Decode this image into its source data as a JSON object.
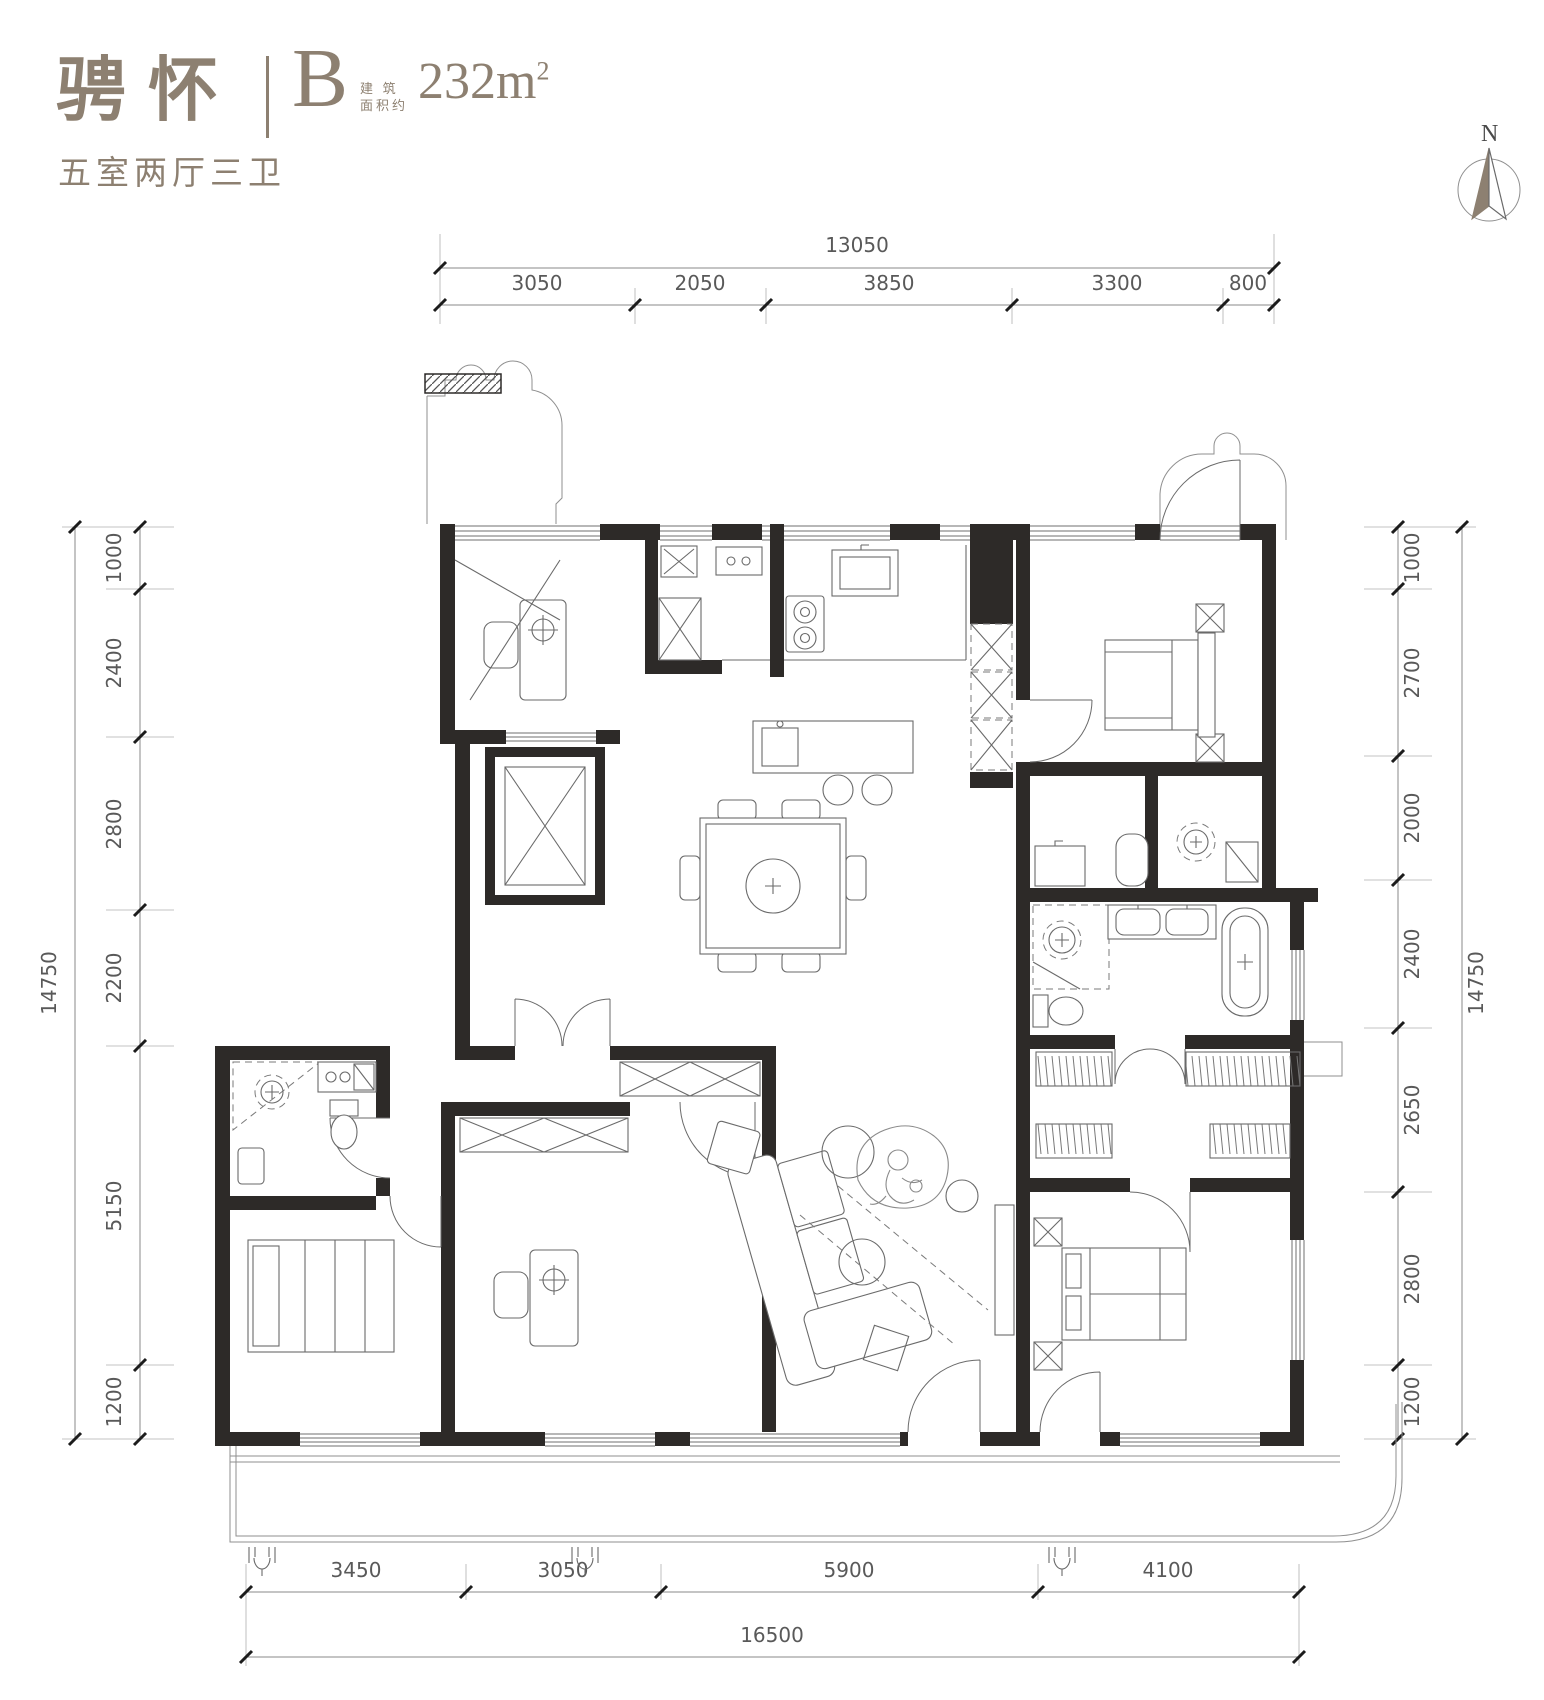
{
  "header": {
    "title": "骋怀",
    "unit": "B",
    "area_label_line1": "建 筑",
    "area_label_line2": "面积约",
    "area_value": "232m",
    "area_exponent": "2",
    "layout_summary": "五室两厅三卫"
  },
  "compass": {
    "north_label": "N"
  },
  "dimensions": {
    "top": {
      "total": "13050",
      "segments": [
        "3050",
        "2050",
        "3850",
        "3300",
        "800"
      ]
    },
    "bottom": {
      "total": "16500",
      "segments": [
        "3450",
        "3050",
        "5900",
        "4100"
      ]
    },
    "left": {
      "total": "14750",
      "segments": [
        "1000",
        "2400",
        "2800",
        "2200",
        "5150",
        "1200"
      ]
    },
    "right": {
      "total": "14750",
      "segments": [
        "1000",
        "2700",
        "2000",
        "2400",
        "2650",
        "2800",
        "1200"
      ]
    }
  },
  "colors": {
    "accent": "#8d8071",
    "wall": "#2d2a28",
    "dim_text": "#595959",
    "line": "#6a6a6a"
  }
}
